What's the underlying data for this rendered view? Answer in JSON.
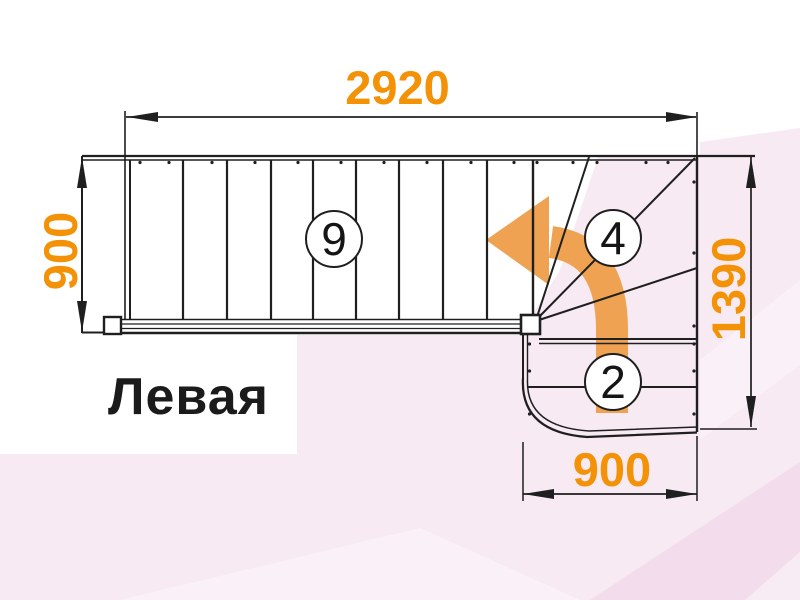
{
  "title": {
    "label": "Левая"
  },
  "dimensions": {
    "top": {
      "value": "2920"
    },
    "left": {
      "value": "900"
    },
    "right": {
      "value": "1390"
    },
    "bottom": {
      "value": "900"
    }
  },
  "step_counts": {
    "straight_flight": "9",
    "winders": "4",
    "bottom_flight": "2"
  },
  "icons": {
    "turn_arrow": "left-turn-arrow-icon"
  },
  "colors": {
    "dimension_text": "#F39206",
    "turn_arrow": "#EFA251",
    "drawing_line": "#1F1F1F",
    "background_pink": "#F7EAF3"
  }
}
